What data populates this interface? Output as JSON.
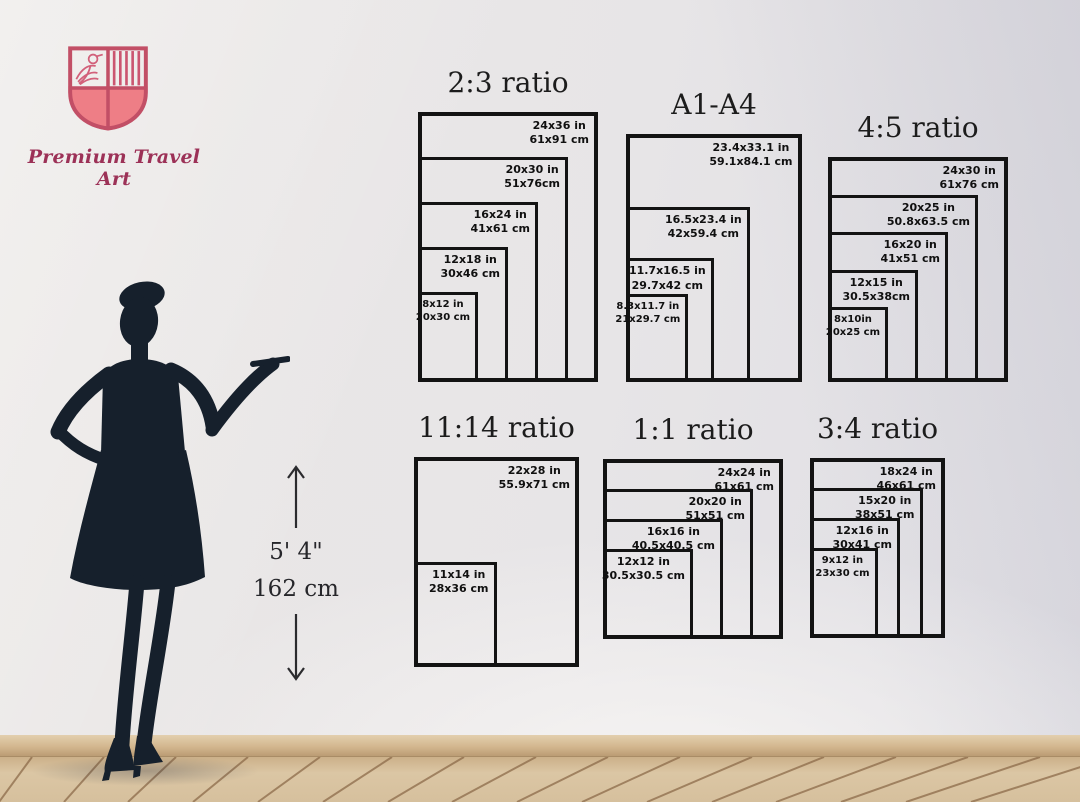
{
  "brand": {
    "name": "Premium Travel Art",
    "logo_icon": "shield-crest-icon",
    "text_color": "#9c3157",
    "shield_stroke_color": "#c24f66",
    "shield_fill_color": "#ee7e86"
  },
  "scene": {
    "wall_color": "#e6e4e6",
    "floor_color": "#d8c2a0",
    "baseboard_color": "#d3b78f",
    "silhouette_color": "#16202c",
    "silhouette_subject": "woman-presenting-silhouette"
  },
  "height_indicator": {
    "up_icon": "arrow-up-icon",
    "down_icon": "arrow-down-icon",
    "feet": "5' 4\"",
    "cm": "162 cm"
  },
  "size_charts": [
    {
      "title": "2:3 ratio",
      "sizes": [
        {
          "in": "24x36 in",
          "cm": "61x91 cm",
          "w": 24,
          "h": 36
        },
        {
          "in": "20x30 in",
          "cm": "51x76cm",
          "w": 20,
          "h": 30
        },
        {
          "in": "16x24 in",
          "cm": "41x61 cm",
          "w": 16,
          "h": 24
        },
        {
          "in": "12x18 in",
          "cm": "30x46 cm",
          "w": 12,
          "h": 18
        },
        {
          "in": "8x12 in",
          "cm": "20x30 cm",
          "w": 8,
          "h": 12
        }
      ]
    },
    {
      "title": "A1-A4",
      "sizes": [
        {
          "in": "23.4x33.1 in",
          "cm": "59.1x84.1 cm",
          "w": 23.4,
          "h": 33.1
        },
        {
          "in": "16.5x23.4 in",
          "cm": "42x59.4 cm",
          "w": 16.5,
          "h": 23.4
        },
        {
          "in": "11.7x16.5 in",
          "cm": "29.7x42 cm",
          "w": 11.7,
          "h": 16.5
        },
        {
          "in": "8.3x11.7 in",
          "cm": "21x29.7 cm",
          "w": 8.3,
          "h": 11.7
        }
      ]
    },
    {
      "title": "4:5 ratio",
      "sizes": [
        {
          "in": "24x30 in",
          "cm": "61x76 cm",
          "w": 24,
          "h": 30
        },
        {
          "in": "20x25 in",
          "cm": "50.8x63.5 cm",
          "w": 20,
          "h": 25
        },
        {
          "in": "16x20 in",
          "cm": "41x51 cm",
          "w": 16,
          "h": 20
        },
        {
          "in": "12x15 in",
          "cm": "30.5x38cm",
          "w": 12,
          "h": 15
        },
        {
          "in": "8x10in",
          "cm": "20x25 cm",
          "w": 8,
          "h": 10
        }
      ]
    },
    {
      "title": "11:14 ratio",
      "sizes": [
        {
          "in": "22x28 in",
          "cm": "55.9x71 cm",
          "w": 22,
          "h": 28
        },
        {
          "in": "11x14 in",
          "cm": "28x36 cm",
          "w": 11,
          "h": 14
        }
      ]
    },
    {
      "title": "1:1 ratio",
      "sizes": [
        {
          "in": "24x24 in",
          "cm": "61x61 cm",
          "w": 24,
          "h": 24
        },
        {
          "in": "20x20 in",
          "cm": "51x51 cm",
          "w": 20,
          "h": 20
        },
        {
          "in": "16x16 in",
          "cm": "40.5x40.5 cm",
          "w": 16,
          "h": 16
        },
        {
          "in": "12x12 in",
          "cm": "30.5x30.5 cm",
          "w": 12,
          "h": 12
        }
      ]
    },
    {
      "title": "3:4 ratio",
      "sizes": [
        {
          "in": "18x24 in",
          "cm": "46x61 cm",
          "w": 18,
          "h": 24
        },
        {
          "in": "15x20 in",
          "cm": "38x51 cm",
          "w": 15,
          "h": 20
        },
        {
          "in": "12x16 in",
          "cm": "30x41 cm",
          "w": 12,
          "h": 16
        },
        {
          "in": "9x12 in",
          "cm": "23x30 cm",
          "w": 9,
          "h": 12
        }
      ]
    }
  ]
}
